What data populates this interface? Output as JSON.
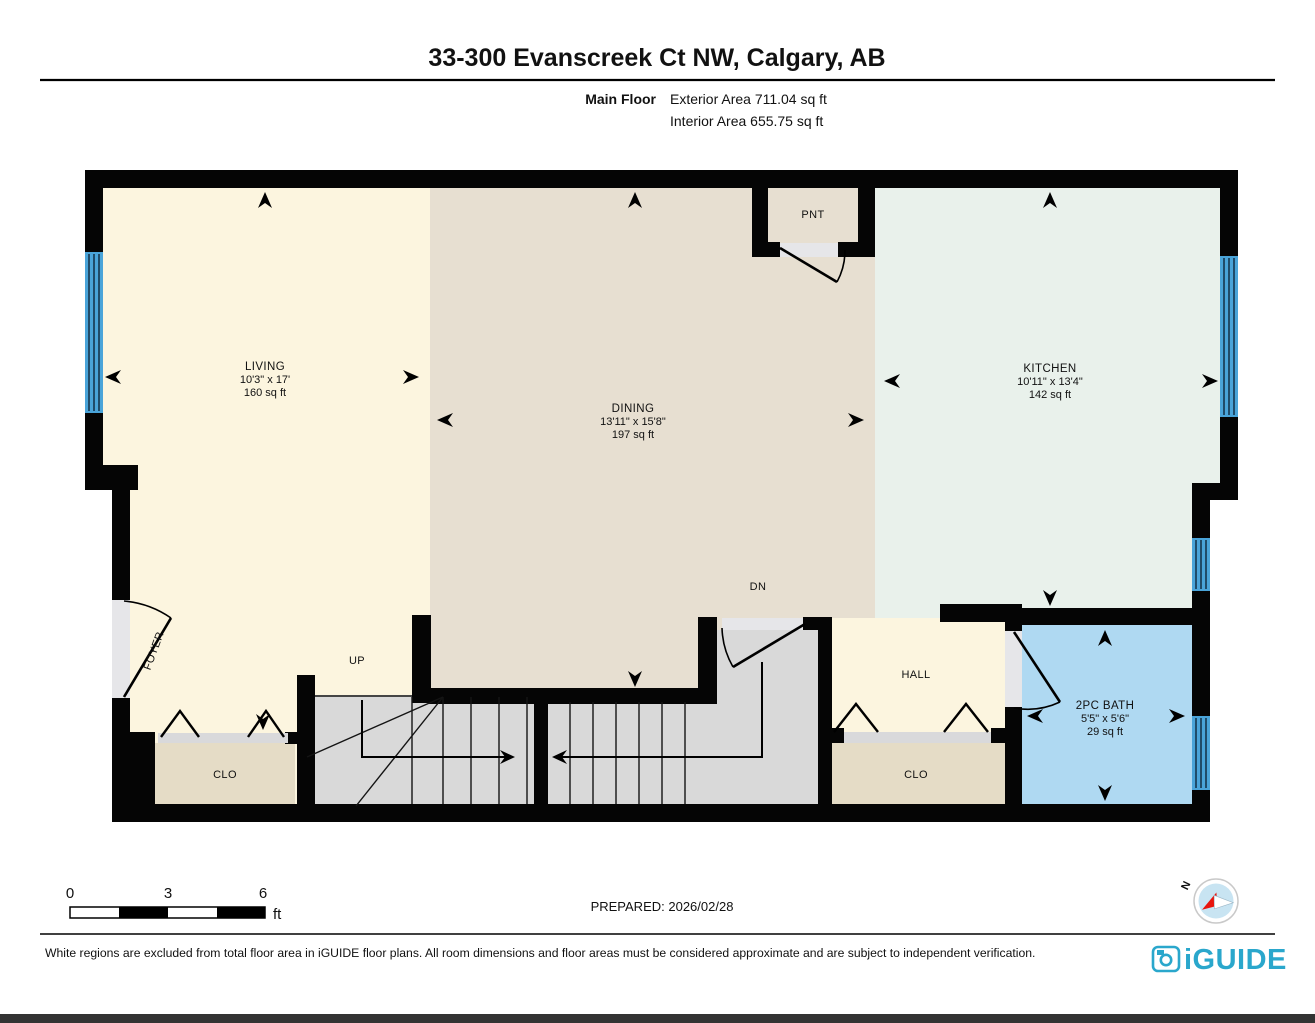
{
  "header": {
    "title": "33-300 Evanscreek Ct NW, Calgary, AB",
    "floor_label": "Main Floor",
    "exterior_area": "Exterior Area 711.04 sq ft",
    "interior_area": "Interior Area 655.75 sq ft"
  },
  "rooms": {
    "living": {
      "name": "LIVING",
      "dims": "10'3\" x 17'",
      "area": "160 sq ft"
    },
    "dining": {
      "name": "DINING",
      "dims": "13'11\" x 15'8\"",
      "area": "197 sq ft"
    },
    "kitchen": {
      "name": "KITCHEN",
      "dims": "10'11\" x 13'4\"",
      "area": "142 sq ft"
    },
    "bath": {
      "name": "2PC BATH",
      "dims": "5'5\" x 5'6\"",
      "area": "29 sq ft"
    },
    "pantry": {
      "name": "PNT"
    },
    "foyer": {
      "name": "FOYER"
    },
    "hall": {
      "name": "HALL"
    },
    "closet_left": {
      "name": "CLO"
    },
    "closet_right": {
      "name": "CLO"
    },
    "stairs_up": {
      "name": "UP"
    },
    "stairs_down": {
      "name": "DN"
    }
  },
  "scale_bar": {
    "tick0": "0",
    "tick1": "3",
    "tick2": "6",
    "unit": "ft"
  },
  "compass": {
    "north": "N"
  },
  "footer": {
    "prepared": "PREPARED: 2026/02/28",
    "disclaimer": "White regions are excluded from total floor area in iGUIDE floor plans. All room dimensions and floor areas must be considered approximate and are subject to independent verification.",
    "brand": "iGUIDE"
  },
  "colors": {
    "wall": "#050505",
    "living_cream": "#FCF5DF",
    "dining_beige": "#E7DFD1",
    "kitchen_mint": "#E9F1EB",
    "bath_blue": "#AFD9F2",
    "closet_tan": "#E5DCC6",
    "stair_gray": "#D9D9D9",
    "opening_gray": "#E6E6E9",
    "window_blue": "#4AA4D9",
    "brand_blue": "#2AA7CC",
    "compass_red": "#E8150D"
  }
}
